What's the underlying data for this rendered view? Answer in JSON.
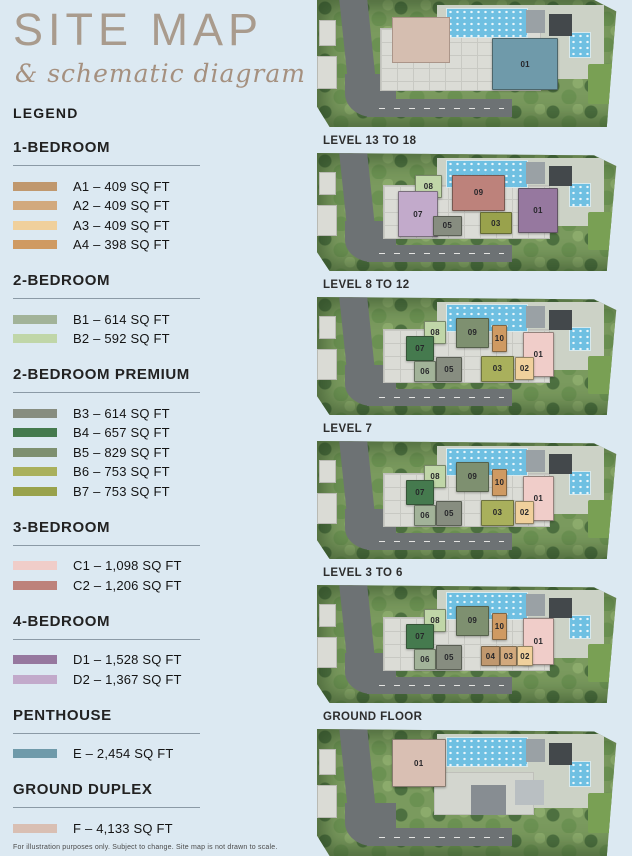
{
  "title": {
    "main": "SITE MAP",
    "sub": "& schematic diagram"
  },
  "legend": {
    "heading": "LEGEND",
    "sections": [
      {
        "name": "1-BEDROOM",
        "items": [
          {
            "code": "A1",
            "label": "A1 – 409 SQ FT",
            "color": "#c0986e"
          },
          {
            "code": "A2",
            "label": "A2 – 409 SQ FT",
            "color": "#d2a97d"
          },
          {
            "code": "A3",
            "label": "A3 – 409 SQ FT",
            "color": "#f0d09c"
          },
          {
            "code": "A4",
            "label": "A4 – 398 SQ FT",
            "color": "#cf9a62"
          }
        ]
      },
      {
        "name": "2-BEDROOM",
        "items": [
          {
            "code": "B1",
            "label": "B1 – 614 SQ FT",
            "color": "#a2b399"
          },
          {
            "code": "B2",
            "label": "B2 – 592 SQ FT",
            "color": "#c0d6a8"
          }
        ]
      },
      {
        "name": "2-BEDROOM PREMIUM",
        "items": [
          {
            "code": "B3",
            "label": "B3 – 614 SQ FT",
            "color": "#878d80"
          },
          {
            "code": "B4",
            "label": "B4 – 657 SQ FT",
            "color": "#457a4e"
          },
          {
            "code": "B5",
            "label": "B5 – 829 SQ FT",
            "color": "#7e9070"
          },
          {
            "code": "B6",
            "label": "B6 – 753 SQ FT",
            "color": "#a9b05c"
          },
          {
            "code": "B7",
            "label": "B7 – 753 SQ FT",
            "color": "#99a24c"
          }
        ]
      },
      {
        "name": "3-BEDROOM",
        "items": [
          {
            "code": "C1",
            "label": "C1 – 1,098 SQ FT",
            "color": "#f0cdc9"
          },
          {
            "code": "C2",
            "label": "C2 – 1,206 SQ FT",
            "color": "#bd827b"
          }
        ]
      },
      {
        "name": "4-BEDROOM",
        "items": [
          {
            "code": "D1",
            "label": "D1 – 1,528 SQ FT",
            "color": "#96789f"
          },
          {
            "code": "D2",
            "label": "D2 – 1,367 SQ FT",
            "color": "#c2aacb"
          }
        ]
      },
      {
        "name": "PENTHOUSE",
        "items": [
          {
            "code": "E",
            "label": "E – 2,454 SQ FT",
            "color": "#6f9aaa"
          }
        ]
      },
      {
        "name": "GROUND DUPLEX",
        "items": [
          {
            "code": "F",
            "label": "F – 4,133 SQ FT",
            "color": "#d9bfb3"
          }
        ]
      }
    ]
  },
  "maps": [
    {
      "id": "site",
      "label": "",
      "variant": "site",
      "features": [
        {
          "name": "roof",
          "color": "#d5beb0",
          "x": 23.8,
          "y": 13,
          "w": 18.4,
          "h": 37
        }
      ],
      "units": [
        {
          "num": "01",
          "color": "#6f9aaa",
          "x": 55.6,
          "y": 30,
          "w": 21,
          "h": 41
        }
      ]
    },
    {
      "id": "level-13-18",
      "label": "LEVEL 13 TO 18",
      "variant": "tower",
      "units": [
        {
          "num": "08",
          "color": "#c0d6a8",
          "x": 31.1,
          "y": 18.5,
          "w": 8.6,
          "h": 19.5
        },
        {
          "num": "09",
          "color": "#bd827b",
          "x": 42.9,
          "y": 18.5,
          "w": 16.8,
          "h": 30.5
        },
        {
          "num": "01",
          "color": "#96789f",
          "x": 63.8,
          "y": 29.5,
          "w": 12.7,
          "h": 38.5
        },
        {
          "num": "07",
          "color": "#c2aacb",
          "x": 25.7,
          "y": 32,
          "w": 12.7,
          "h": 39.5
        },
        {
          "num": "05",
          "color": "#878d80",
          "x": 36.8,
          "y": 53,
          "w": 9.2,
          "h": 17
        },
        {
          "num": "03",
          "color": "#99a24c",
          "x": 51.7,
          "y": 50,
          "w": 10.2,
          "h": 19
        }
      ]
    },
    {
      "id": "level-8-12",
      "label": "LEVEL 8 TO 12",
      "variant": "tower",
      "units": [
        {
          "num": "01",
          "color": "#f0cdc9",
          "x": 65.4,
          "y": 30,
          "w": 9.8,
          "h": 38
        },
        {
          "num": "08",
          "color": "#c0d6a8",
          "x": 34.0,
          "y": 20,
          "w": 7.0,
          "h": 20
        },
        {
          "num": "09",
          "color": "#7e9070",
          "x": 44.1,
          "y": 18,
          "w": 10.5,
          "h": 25
        },
        {
          "num": "10",
          "color": "#cf9a62",
          "x": 55.6,
          "y": 23.5,
          "w": 4.7,
          "h": 23.5
        },
        {
          "num": "07",
          "color": "#457a4e",
          "x": 28.3,
          "y": 33,
          "w": 8.8,
          "h": 21
        },
        {
          "num": "06",
          "color": "#a2b399",
          "x": 30.8,
          "y": 54,
          "w": 7.0,
          "h": 18
        },
        {
          "num": "05",
          "color": "#878d80",
          "x": 37.8,
          "y": 51,
          "w": 8.2,
          "h": 21
        },
        {
          "num": "03",
          "color": "#a9b05c",
          "x": 52.1,
          "y": 50,
          "w": 10.4,
          "h": 22
        },
        {
          "num": "02",
          "color": "#f0d09c",
          "x": 62.9,
          "y": 51,
          "w": 6.0,
          "h": 19
        }
      ]
    },
    {
      "id": "level-7",
      "label": "LEVEL 7",
      "variant": "tower",
      "units": [
        {
          "num": "01",
          "color": "#f0cdc9",
          "x": 65.4,
          "y": 30,
          "w": 9.8,
          "h": 38
        },
        {
          "num": "08",
          "color": "#c0d6a8",
          "x": 34.0,
          "y": 20,
          "w": 7.0,
          "h": 20
        },
        {
          "num": "09",
          "color": "#7e9070",
          "x": 44.1,
          "y": 18,
          "w": 10.5,
          "h": 25
        },
        {
          "num": "10",
          "color": "#cf9a62",
          "x": 55.6,
          "y": 23.5,
          "w": 4.7,
          "h": 23.5
        },
        {
          "num": "07",
          "color": "#457a4e",
          "x": 28.3,
          "y": 33,
          "w": 8.8,
          "h": 21
        },
        {
          "num": "06",
          "color": "#a2b399",
          "x": 30.8,
          "y": 54,
          "w": 7.0,
          "h": 18
        },
        {
          "num": "05",
          "color": "#878d80",
          "x": 37.8,
          "y": 51,
          "w": 8.2,
          "h": 21
        },
        {
          "num": "03",
          "color": "#a9b05c",
          "x": 52.1,
          "y": 50,
          "w": 10.4,
          "h": 22
        },
        {
          "num": "02",
          "color": "#f0d09c",
          "x": 62.9,
          "y": 51,
          "w": 6.0,
          "h": 19
        }
      ]
    },
    {
      "id": "level-3-6",
      "label": "LEVEL 3 TO 6",
      "variant": "tower",
      "units": [
        {
          "num": "01",
          "color": "#f0cdc9",
          "x": 65.4,
          "y": 28,
          "w": 9.8,
          "h": 40
        },
        {
          "num": "08",
          "color": "#c0d6a8",
          "x": 34.0,
          "y": 20,
          "w": 7.0,
          "h": 20
        },
        {
          "num": "09",
          "color": "#7e9070",
          "x": 44.1,
          "y": 18,
          "w": 10.5,
          "h": 25
        },
        {
          "num": "10",
          "color": "#cf9a62",
          "x": 55.6,
          "y": 23.5,
          "w": 4.7,
          "h": 23.5
        },
        {
          "num": "07",
          "color": "#457a4e",
          "x": 28.3,
          "y": 33,
          "w": 8.8,
          "h": 21
        },
        {
          "num": "06",
          "color": "#a2b399",
          "x": 30.8,
          "y": 54,
          "w": 7.0,
          "h": 18
        },
        {
          "num": "05",
          "color": "#878d80",
          "x": 37.8,
          "y": 51,
          "w": 8.2,
          "h": 21
        },
        {
          "num": "04",
          "color": "#c0986e",
          "x": 52.1,
          "y": 52,
          "w": 6.0,
          "h": 17
        },
        {
          "num": "03",
          "color": "#d2a97d",
          "x": 58.1,
          "y": 52,
          "w": 5.4,
          "h": 17
        },
        {
          "num": "02",
          "color": "#f0d09c",
          "x": 63.5,
          "y": 52,
          "w": 5.1,
          "h": 17
        }
      ]
    },
    {
      "id": "ground-floor",
      "label": "GROUND FLOOR",
      "variant": "ground",
      "units": [
        {
          "num": "01",
          "color": "#d9bfb3",
          "x": 23.8,
          "y": 8,
          "w": 17,
          "h": 38
        }
      ]
    }
  ],
  "footnote": "For illustration purposes only. Subject to change. Site map is not drawn to scale."
}
